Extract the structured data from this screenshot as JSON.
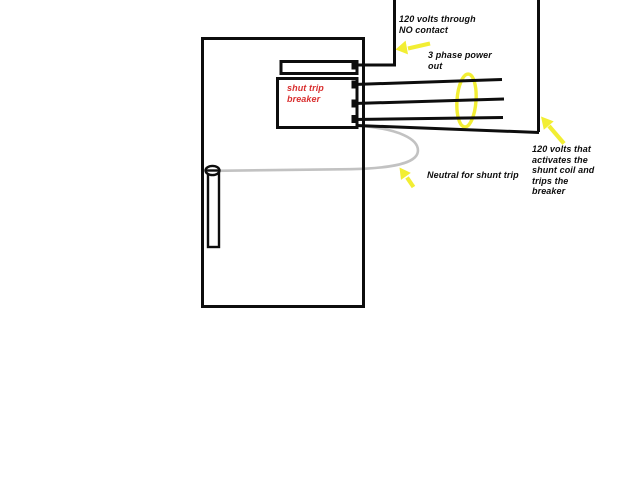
{
  "colors": {
    "bg": "#ffffff",
    "ink": "#0d0d0d",
    "red": "#d92f2f",
    "yellow": "#f2ee33",
    "wire": "#c2c2c2"
  },
  "labels": {
    "no_contact": "120 volts through\nNO contact",
    "three_phase_out": "3 phase power\nout",
    "shunt_trip_breaker": "shut trip\nbreaker",
    "neutral_shunt_trip": "Neutral for shunt trip",
    "shunt_coil_note": "120 volts that\nactivates the\nshunt coil and\ntrips the\nbreaker"
  }
}
